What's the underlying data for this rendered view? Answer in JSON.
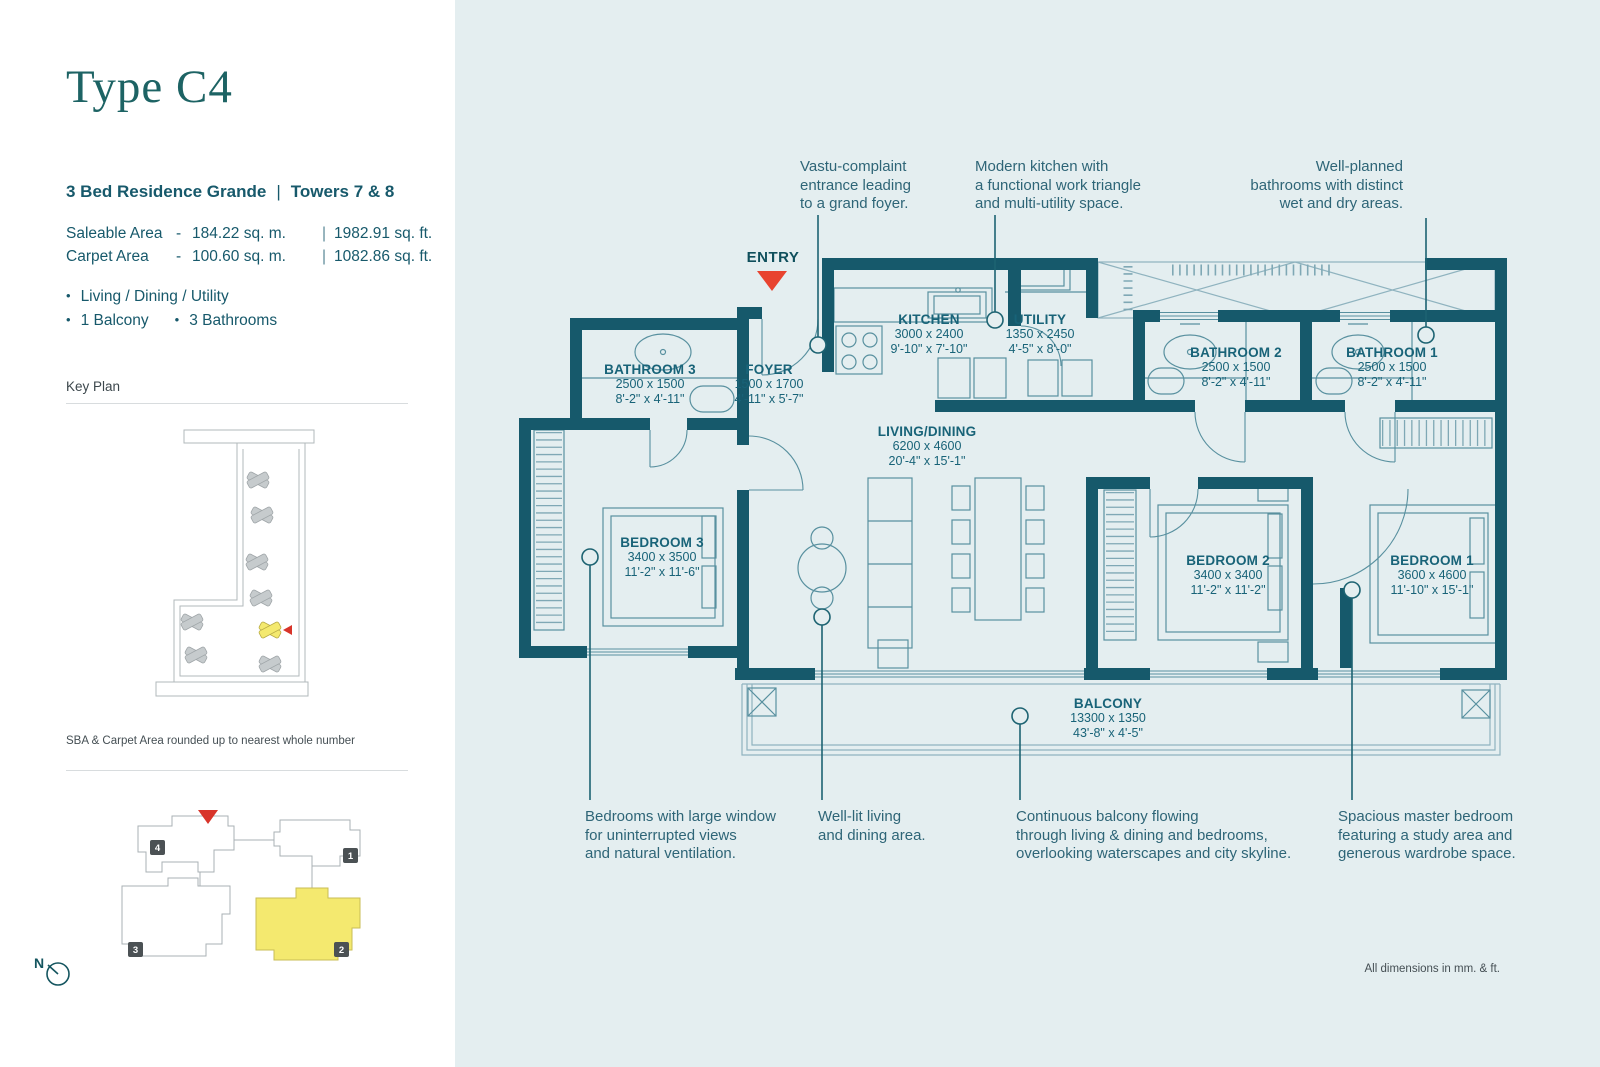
{
  "left_panel": {
    "title": "Type C4",
    "subtitle": "3 Bed Residence Grande",
    "pipe": "|",
    "towers": "Towers 7 & 8",
    "bullet": "•",
    "dash": "-",
    "areas": [
      {
        "label": "Saleable Area",
        "metric": "184.22 sq. m.",
        "imperial": "1982.91 sq. ft."
      },
      {
        "label": "Carpet Area",
        "metric": "100.60 sq. m.",
        "imperial": "1082.86 sq. ft."
      }
    ],
    "features_line1": "Living / Dining / Utility",
    "features_line2a": "1 Balcony",
    "features_line2b": "3 Bathrooms",
    "key_plan_label": "Key Plan",
    "sba_note": "SBA & Carpet Area rounded up to nearest whole number",
    "tower_badges": [
      "1",
      "2",
      "3",
      "4"
    ],
    "north_label": "N"
  },
  "plan": {
    "entry_label": "ENTRY",
    "rooms": [
      {
        "name": "BATHROOM 3",
        "mm": "2500 x 1500",
        "ft": "8'-2\" x 4'-11\""
      },
      {
        "name": "FOYER",
        "mm": "1500 x 1700",
        "ft": "4'-11\" x 5'-7\""
      },
      {
        "name": "KITCHEN",
        "mm": "3000 x 2400",
        "ft": "9'-10\" x 7'-10\""
      },
      {
        "name": "UTILITY",
        "mm": "1350 x 2450",
        "ft": "4'-5\" x 8'-0\""
      },
      {
        "name": "BATHROOM 2",
        "mm": "2500 x 1500",
        "ft": "8'-2\" x 4'-11\""
      },
      {
        "name": "BATHROOM 1",
        "mm": "2500 x 1500",
        "ft": "8'-2\" x 4'-11\""
      },
      {
        "name": "LIVING/DINING",
        "mm": "6200 x 4600",
        "ft": "20'-4\" x 15'-1\""
      },
      {
        "name": "BEDROOM 3",
        "mm": "3400 x 3500",
        "ft": "11'-2\" x 11'-6\""
      },
      {
        "name": "BEDROOM 2",
        "mm": "3400 x 3400",
        "ft": "11'-2\" x 11'-2\""
      },
      {
        "name": "BEDROOM 1",
        "mm": "3600 x 4600",
        "ft": "11'-10\" x 15'-1\""
      },
      {
        "name": "BALCONY",
        "mm": "13300 x 1350",
        "ft": "43'-8\" x 4'-5\""
      }
    ],
    "dimensions_note": "All dimensions in mm. & ft."
  },
  "annotations": {
    "top": [
      {
        "lines": [
          "Vastu-complaint",
          "entrance leading",
          "to a grand foyer."
        ]
      },
      {
        "lines": [
          "Modern kitchen with",
          "a functional work triangle",
          "and multi-utility space."
        ]
      },
      {
        "lines": [
          "Well-planned",
          "bathrooms with distinct",
          "wet and dry areas."
        ]
      }
    ],
    "bottom": [
      {
        "lines": [
          "Bedrooms with large window",
          "for uninterrupted views",
          "and natural ventilation."
        ]
      },
      {
        "lines": [
          "Well-lit living",
          "and dining area."
        ]
      },
      {
        "lines": [
          "Continuous balcony flowing",
          "through living & dining and bedrooms,",
          "overlooking waterscapes and city skyline."
        ]
      },
      {
        "lines": [
          "Spacious master bedroom",
          "featuring a study area and",
          "generous wardrobe space."
        ]
      }
    ]
  },
  "colors": {
    "wall": "#16596b",
    "background": "#e4eef0",
    "accent_red": "#e8432f",
    "highlight_yellow": "#f4e96f",
    "text_teal": "#17596b"
  }
}
